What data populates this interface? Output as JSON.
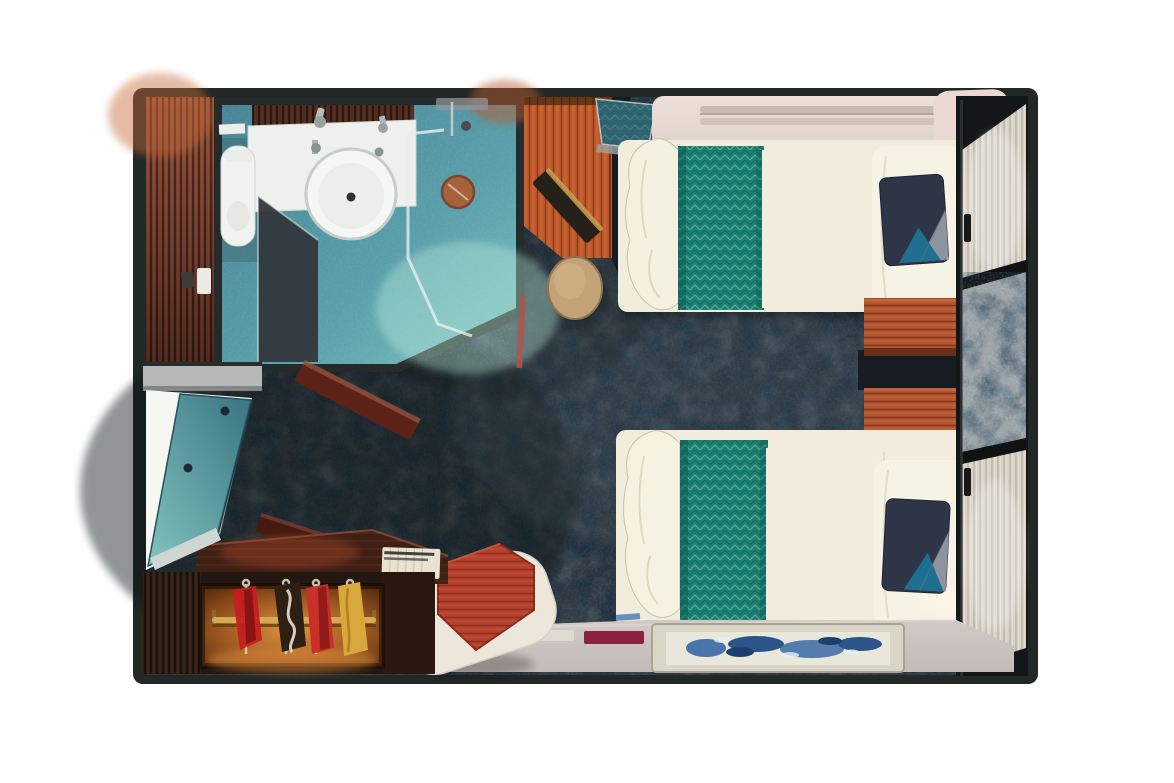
{
  "scene": {
    "type": "floorplan-3d-top-view",
    "subject": "cruise ship stateroom rendering",
    "rooms": [
      {
        "id": "bathroom",
        "items": [
          "sink-counter",
          "wash-basin",
          "toilet",
          "glass-partition",
          "shower-enclosure",
          "shower-mat",
          "shower-fixtures"
        ]
      },
      {
        "id": "main-cabin",
        "items": [
          "desk",
          "desk-stool",
          "valet-tray",
          "pullman-berth-folded",
          "twin-bed-upper",
          "twin-bed-lower",
          "nightstand-1",
          "nightstand-2",
          "headboard-panel",
          "curtain-wall",
          "area-rug",
          "bench",
          "side-table",
          "vanity-counter",
          "wardrobe",
          "entry-door-open"
        ]
      }
    ],
    "furniture": [
      {
        "name": "entry-door",
        "state": "open"
      },
      {
        "name": "twin-bed",
        "count": 2,
        "bedding": [
          "cream-duvet",
          "teal-runner",
          "navy-accent-pillow"
        ]
      },
      {
        "name": "nightstand",
        "count": 2
      },
      {
        "name": "wardrobe",
        "contents": "hanging-clothes-on-gold-rod"
      },
      {
        "name": "desk-with-stool",
        "count": 1
      },
      {
        "name": "bench-with-red-table",
        "count": 1
      },
      {
        "name": "area-rug",
        "art": "blue-wave-pattern"
      }
    ]
  },
  "palette": {
    "wall": "#212826",
    "carpet": "#2c353e",
    "bath_floor": "#5599a7",
    "glass_dark": "#31373c",
    "fixture_white": "#f2f3f0",
    "sink_white": "#eef0ec",
    "shower_mat": "#a7613c",
    "entry_wood": "#6e3a2b",
    "desk_wood": "#c25b2b",
    "stool_tan": "#c3a277",
    "berth_shelf": "#e7dcd5",
    "bedding": "#f1ecdb",
    "bed_runner": "#1b8172",
    "pillow_navy": "#2e3547",
    "pillow_blue": "#1f6f92",
    "pillow_gray": "#8d949e",
    "nightstand_wood": "#b5552f",
    "headboard": "#e8e2d6",
    "curtain_light": "#d8d2c7",
    "curtain_gray": "#9aa2a6",
    "floor_entry": "#cbc3bf",
    "rug_frame": "#d9d5c7",
    "rug_inner": "#e9e7db",
    "rug_blue": "#3a68a4",
    "amenity_white": "#dedbd3",
    "amenity_maroon": "#8e2140",
    "bench_white": "#ece6db",
    "table_red": "#b8402e",
    "closet_rod": "#d4aa52",
    "door_teal": "#4f93a0",
    "vanity_wood": "#3f2016"
  }
}
